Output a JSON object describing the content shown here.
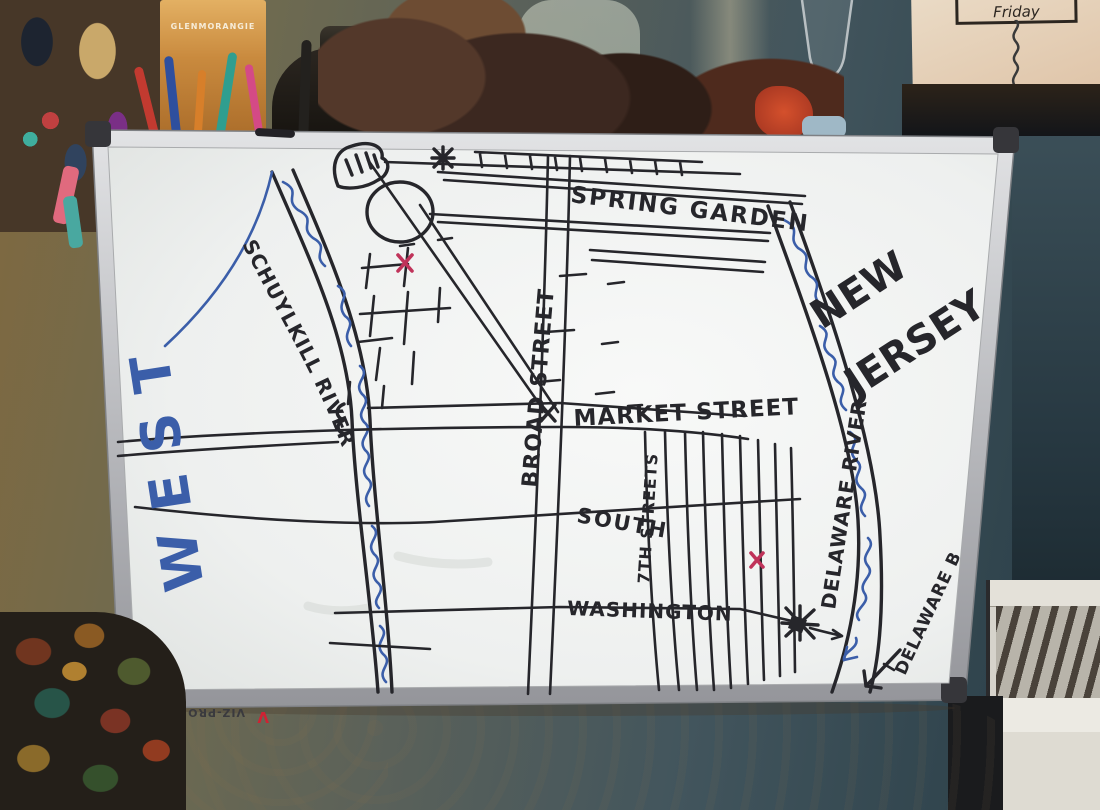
{
  "scene": {
    "note": {
      "title": "Friday"
    },
    "shelf": {
      "elmers_brand": "ELMER'S",
      "whisky_brand": "GLENMORANGIE"
    },
    "colors": {
      "wall_warm": "#80693f",
      "wall_teal": "#31454e",
      "paper": "#e7d4bd",
      "chair": "#ddd0ba"
    }
  },
  "board": {
    "brand": "VIZ-PRO",
    "brand_logo": "V",
    "marker_colors": {
      "black": "#26262b",
      "blue": "#3b5ea9",
      "red": "#c0335a"
    },
    "labels": {
      "spring_garden": "SPRING GARDEN",
      "broad_street": "BROAD STREET",
      "market_street": "MARKET STREET",
      "south": "SOUTH",
      "numbered_streets": "7TH STREETS",
      "washington": "WASHINGTON",
      "schuylkill_river": "SCHUYLKILL RIVER",
      "delaware_river": "DELAWARE RIVER",
      "new_jersey_line1": "NEW",
      "new_jersey_line2": "JERSEY",
      "west": "WEST",
      "delaware_bay": "DELAWARE BAY"
    }
  }
}
